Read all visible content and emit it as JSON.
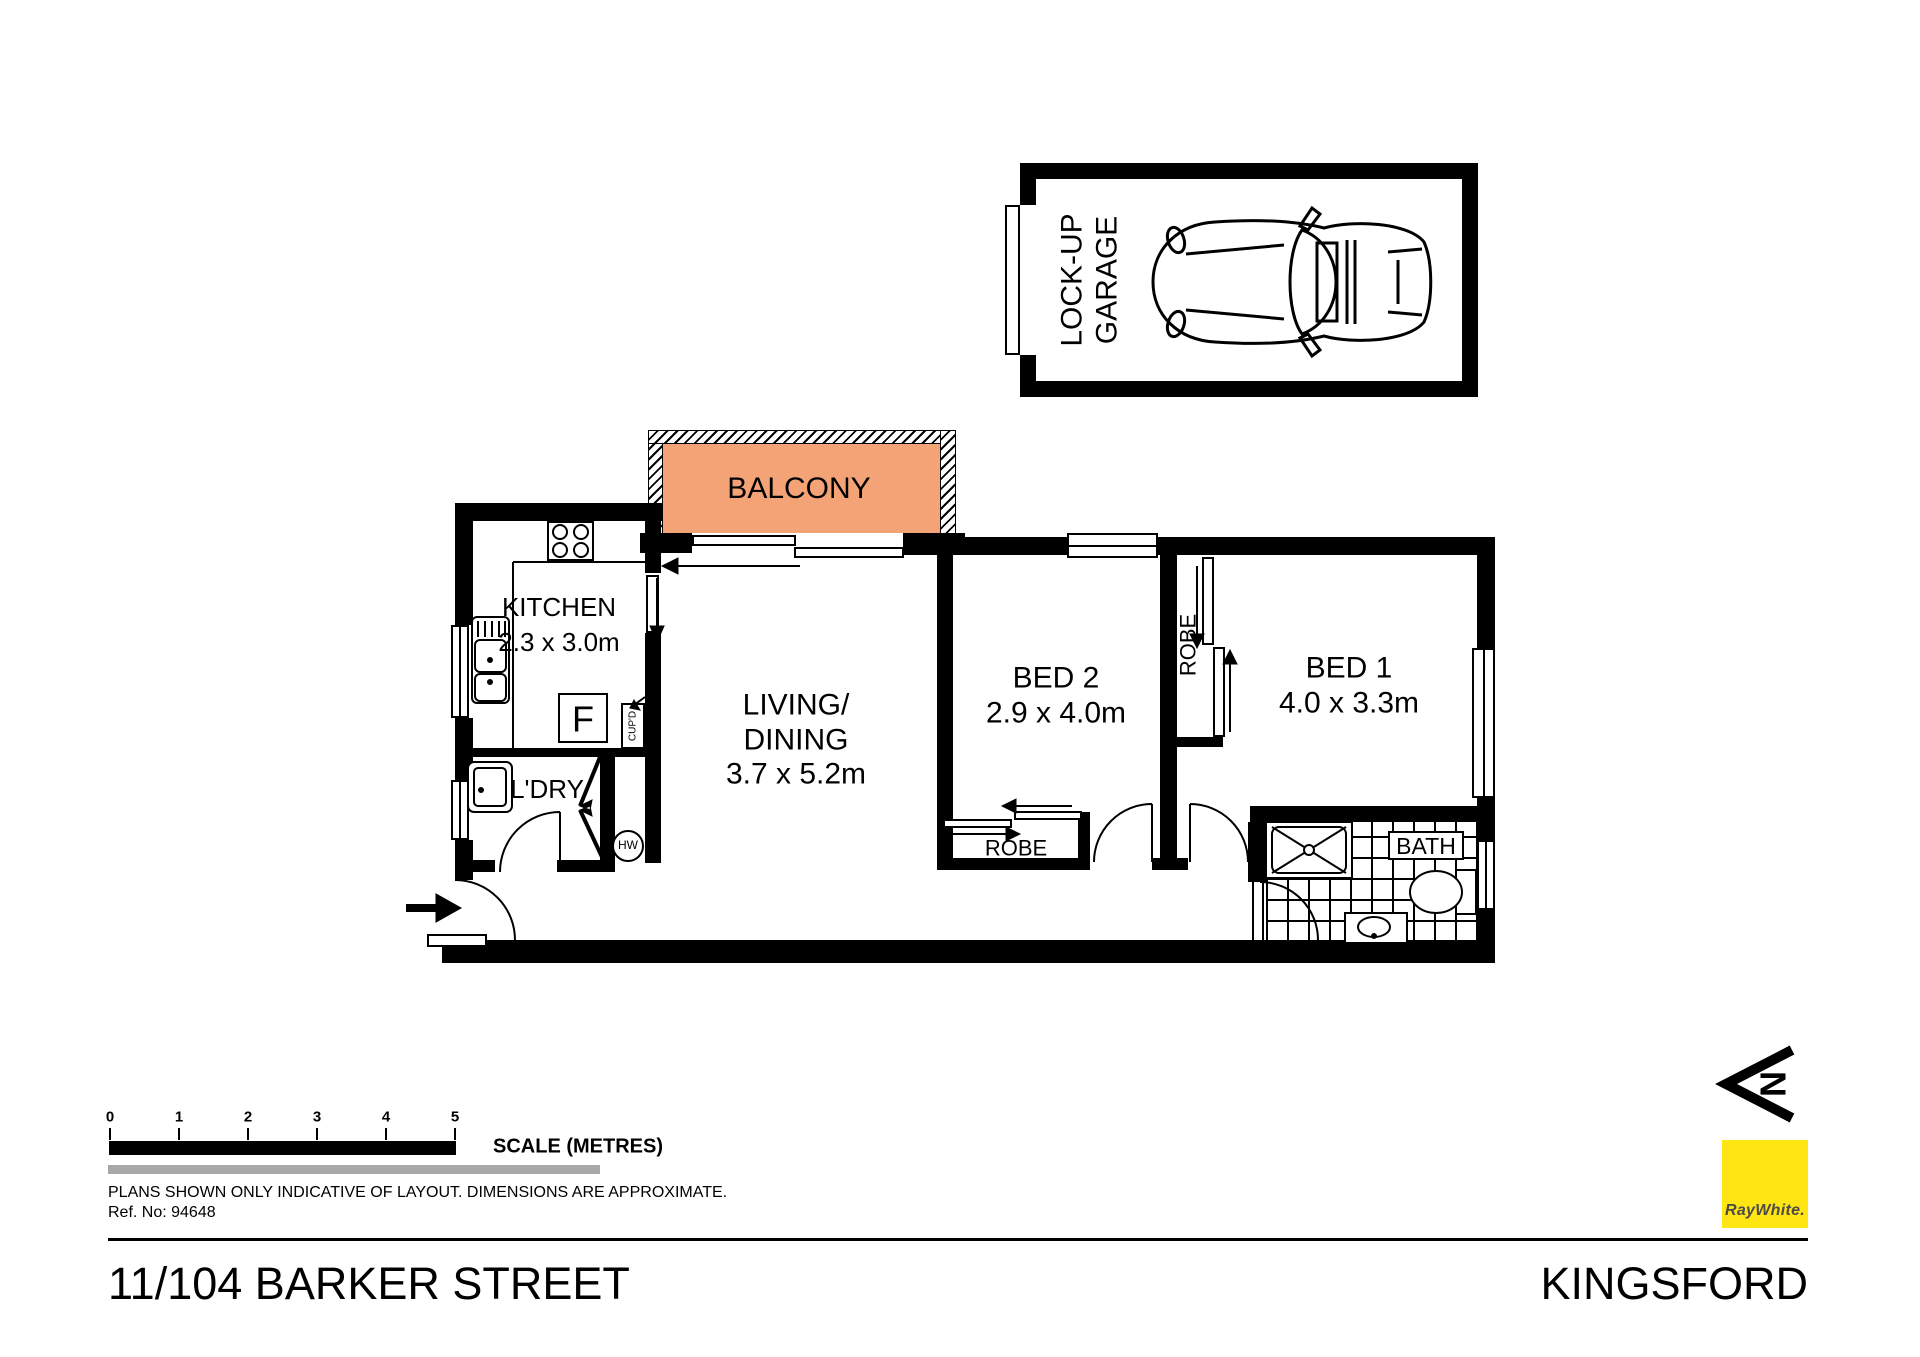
{
  "plan": {
    "garage": {
      "line1": "LOCK-UP",
      "line2": "GARAGE"
    },
    "balcony": {
      "label": "BALCONY"
    },
    "kitchen": {
      "label": "KITCHEN",
      "dims": "2.3 x 3.0m"
    },
    "living": {
      "line1": "LIVING/",
      "line2": "DINING",
      "dims": "3.7 x 5.2m"
    },
    "laundry": {
      "label": "L'DRY"
    },
    "bed2": {
      "label": "BED 2",
      "dims": "2.9 x 4.0m"
    },
    "bed1": {
      "label": "BED 1",
      "dims": "4.0 x 3.3m"
    },
    "bath": {
      "label": "BATH"
    },
    "robe_bed1": {
      "label": "ROBE"
    },
    "robe_bed2": {
      "label": "ROBE"
    },
    "fridge": {
      "label": "F"
    },
    "cupboard": {
      "label": "CUP'D"
    },
    "hot_water": {
      "label": "HW"
    }
  },
  "north": {
    "letter": "N"
  },
  "scale": {
    "ticks": [
      "0",
      "1",
      "2",
      "3",
      "4",
      "5"
    ],
    "label": "SCALE (METRES)"
  },
  "notes": {
    "disclaimer": "PLANS SHOWN ONLY INDICATIVE OF LAYOUT.  DIMENSIONS ARE APPROXIMATE.",
    "ref": "Ref. No: 94648"
  },
  "footer": {
    "address": "11/104 BARKER STREET",
    "suburb": "KINGSFORD"
  },
  "brand": {
    "name": "RayWhite."
  },
  "colors": {
    "wall": "#000000",
    "balcony": "#F4A376",
    "brand_yellow": "#FFE512",
    "grey_bar": "#A8A8A8"
  }
}
